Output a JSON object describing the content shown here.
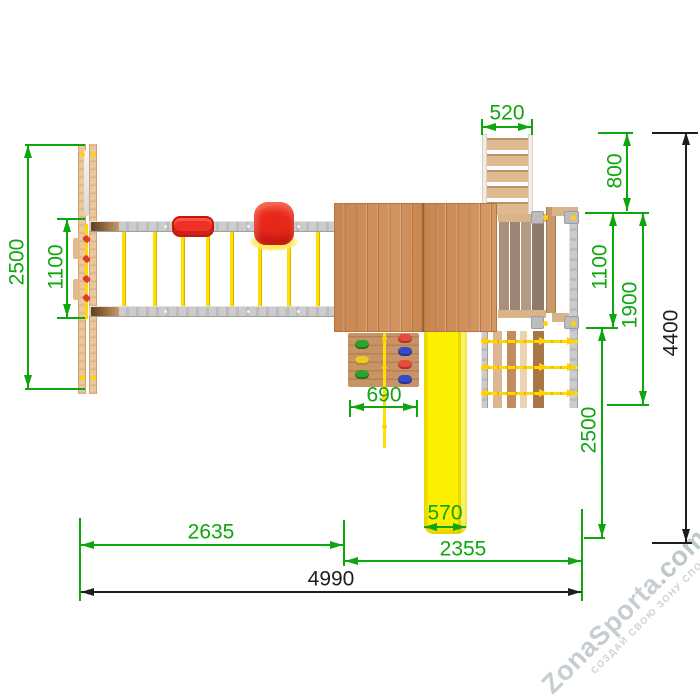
{
  "drawing": {
    "type": "top-view installation plan of wooden playground set",
    "units": "mm"
  },
  "dims": {
    "left_2500": "2500",
    "left_1100": "1100",
    "top_520": "520",
    "right_800": "800",
    "right_1100": "1100",
    "right_1900": "1900",
    "right_2500": "2500",
    "right_4400": "4400",
    "wall_690": "690",
    "slide_570": "570",
    "bottom_2635": "2635",
    "bottom_2355": "2355",
    "bottom_4990": "4990"
  },
  "watermark": {
    "brand": "ZonaSporta",
    "brand_suffix": ".com",
    "tagline": "СОЗДАЙ СВОЮ ЗОНУ СПОРТА"
  },
  "colors": {
    "dimension_green": "#0da60d",
    "dimension_black": "#1e1e1e",
    "slide_yellow": "#fcef00",
    "rope_yellow": "#ffd900",
    "swing_seat_red": "#e8271b",
    "roof_wood_brown": "#ce8c57",
    "frame_wood_tan": "#ecc69d",
    "metal_gray": "#c9c9c9",
    "watermark_gray": "#c7ced1"
  }
}
